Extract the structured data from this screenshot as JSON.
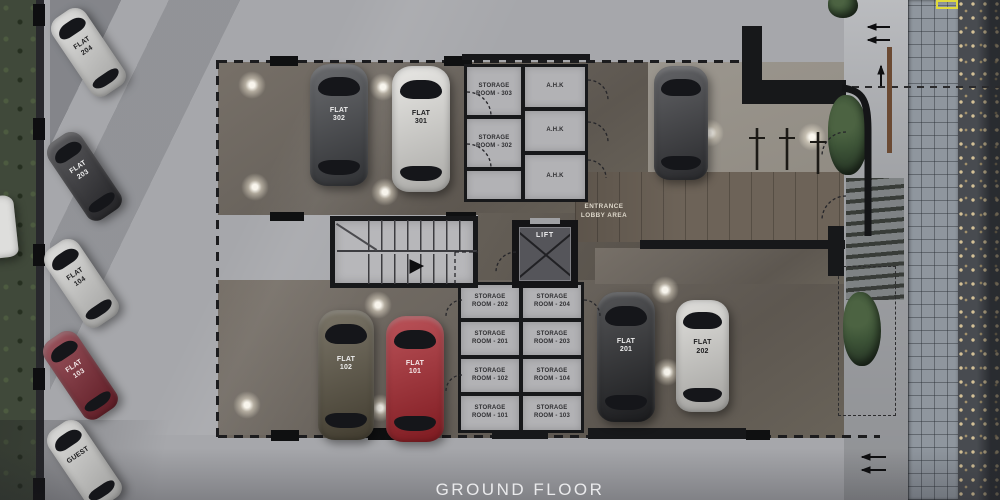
{
  "title": "GROUND FLOOR",
  "plan_labels": {
    "lift": "LIFT",
    "entrance": "ENTRANCE LOBBY AREA"
  },
  "cars": [
    {
      "label": "FLAT 204",
      "color": "#d9d9d7",
      "label_color": "#1d1d1f"
    },
    {
      "label": "FLAT 203",
      "color": "#2f2f33",
      "label_color": "#f0f0f0"
    },
    {
      "label": "FLAT 104",
      "color": "#d7d7d5",
      "label_color": "#1d1d1f"
    },
    {
      "label": "FLAT 103",
      "color": "#7e2531",
      "label_color": "#f2e9e9"
    },
    {
      "label": "GUEST",
      "color": "#d3d3d1",
      "label_color": "#1d1d1f"
    },
    {
      "label": "FLAT 302",
      "color": "#404246",
      "label_color": "#ececec"
    },
    {
      "label": "FLAT 301",
      "color": "#e3e2de",
      "label_color": "#1d1d1f"
    },
    {
      "label": "FLAT 102",
      "color": "#57503f",
      "label_color": "#eeeeee"
    },
    {
      "label": "FLAT 101",
      "color": "#a8232b",
      "label_color": "#f4eaea"
    },
    {
      "label": "FLAT 201",
      "color": "#242528",
      "label_color": "#ececec"
    },
    {
      "label": "FLAT 202",
      "color": "#d8d7d3",
      "label_color": "#1d1d1f"
    },
    {
      "label": "",
      "color": "#37383c",
      "label_color": "#ffffff"
    }
  ],
  "storage_rooms": {
    "upper": [
      "STORAGE ROOM - 303",
      "STORAGE ROOM - 302"
    ],
    "ahk": [
      "A.H.K",
      "A.H.K",
      "A.H.K"
    ],
    "lower_left": [
      "STORAGE ROOM - 202",
      "STORAGE ROOM - 201",
      "STORAGE ROOM - 102",
      "STORAGE ROOM - 101"
    ],
    "lower_right": [
      "STORAGE ROOM - 204",
      "STORAGE ROOM - 203",
      "STORAGE ROOM - 104",
      "STORAGE ROOM - 103"
    ]
  },
  "palette": {
    "accent_yellow": "#e0d93c",
    "concrete": "#a6a7ab",
    "interior_floor": "#6b655e",
    "greenery": "#3e5538"
  }
}
